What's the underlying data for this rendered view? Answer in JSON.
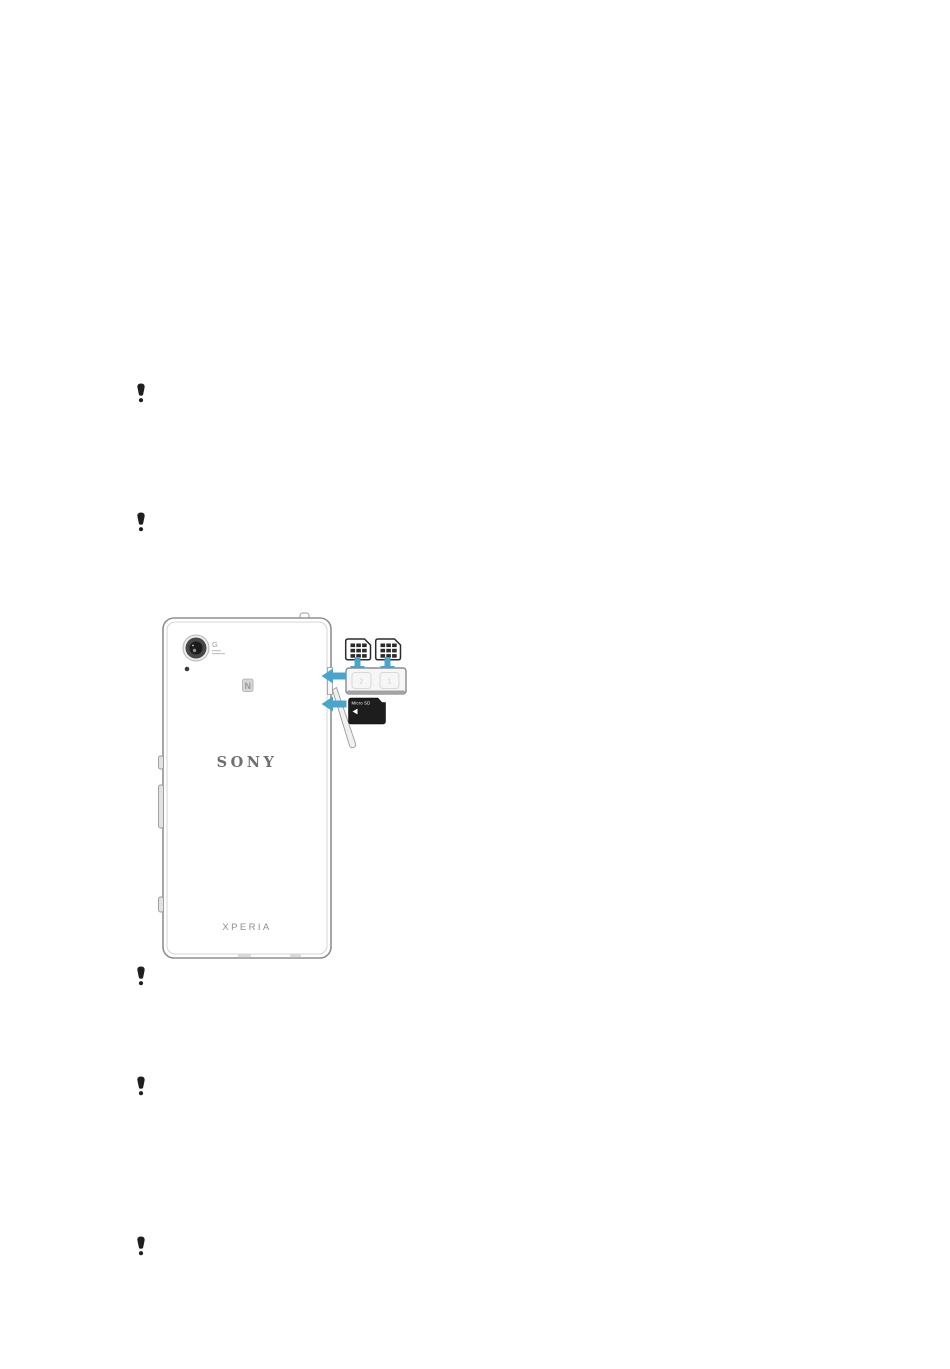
{
  "page": {
    "background": "#ffffff"
  },
  "note_icons": {
    "glyph": "!",
    "color": "#1f1f1f",
    "count": 5
  },
  "device_diagram": {
    "brand": "SONY",
    "model": "XPERIA",
    "camera_label": "G",
    "nfc_label": "N",
    "sim_tray": {
      "slot_left_label": "2",
      "slot_right_label": "1"
    },
    "memory_card": {
      "label": "Micro SD"
    },
    "colors": {
      "arrow_blue": "#4aa5cc",
      "device_outline": "#8f8f8f",
      "logo_gray": "#6f6f6f",
      "icon_black": "#1f1f1f"
    }
  }
}
